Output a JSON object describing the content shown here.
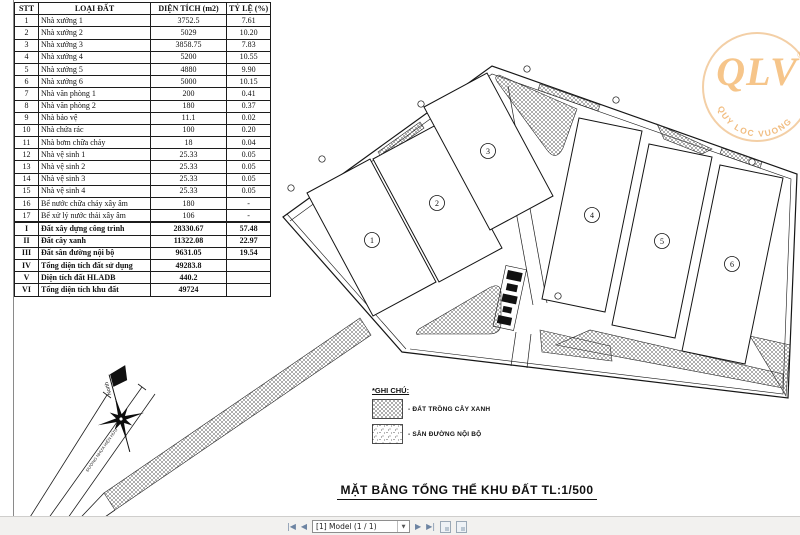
{
  "table": {
    "headers": [
      "STT",
      "LOẠI ĐẤT",
      "DIỆN TÍCH (m2)",
      "TỶ LỆ (%)"
    ],
    "rows": [
      {
        "no": "1",
        "name": "Nhà xưởng 1",
        "area": "3752.5",
        "ratio": "7.61"
      },
      {
        "no": "2",
        "name": "Nhà xưởng 2",
        "area": "5029",
        "ratio": "10.20"
      },
      {
        "no": "3",
        "name": "Nhà xưởng 3",
        "area": "3858.75",
        "ratio": "7.83"
      },
      {
        "no": "4",
        "name": "Nhà xưởng 4",
        "area": "5200",
        "ratio": "10.55"
      },
      {
        "no": "5",
        "name": "Nhà xưởng 5",
        "area": "4880",
        "ratio": "9.90"
      },
      {
        "no": "6",
        "name": "Nhà xưởng 6",
        "area": "5000",
        "ratio": "10.15"
      },
      {
        "no": "7",
        "name": "Nhà văn phòng 1",
        "area": "200",
        "ratio": "0.41"
      },
      {
        "no": "8",
        "name": "Nhà văn phòng 2",
        "area": "180",
        "ratio": "0.37"
      },
      {
        "no": "9",
        "name": "Nhà bảo vệ",
        "area": "11.1",
        "ratio": "0.02"
      },
      {
        "no": "10",
        "name": "Nhà chứa rác",
        "area": "100",
        "ratio": "0.20"
      },
      {
        "no": "11",
        "name": "Nhà bơm chữa cháy",
        "area": "18",
        "ratio": "0.04"
      },
      {
        "no": "12",
        "name": "Nhà vệ sinh 1",
        "area": "25.33",
        "ratio": "0.05"
      },
      {
        "no": "13",
        "name": "Nhà vệ sinh 2",
        "area": "25.33",
        "ratio": "0.05"
      },
      {
        "no": "14",
        "name": "Nhà vệ sinh 3",
        "area": "25.33",
        "ratio": "0.05"
      },
      {
        "no": "15",
        "name": "Nhà vệ sinh 4",
        "area": "25.33",
        "ratio": "0.05"
      },
      {
        "no": "16",
        "name": "Bể nước chữa cháy xây âm",
        "area": "180",
        "ratio": "-"
      },
      {
        "no": "17",
        "name": "Bể xử lý nước thải xây âm",
        "area": "106",
        "ratio": "-"
      },
      {
        "no": "I",
        "name": "Đất xây dựng công trình",
        "area": "28330.67",
        "ratio": "57.48"
      },
      {
        "no": "II",
        "name": "Đất cây xanh",
        "area": "11322.08",
        "ratio": "22.97"
      },
      {
        "no": "III",
        "name": "Đất sân đường nội bộ",
        "area": "9631.05",
        "ratio": "19.54"
      },
      {
        "no": "IV",
        "name": "Tổng diện tích đất sử dụng",
        "area": "49283.8",
        "ratio": ""
      },
      {
        "no": "V",
        "name": "Diện tích đất HLADB",
        "area": "440.2",
        "ratio": ""
      },
      {
        "no": "VI",
        "name": "Tổng diện tích khu đất",
        "area": "49724",
        "ratio": ""
      }
    ]
  },
  "plan": {
    "title": "MẶT BẰNG TỔNG THỂ KHU ĐẤT TL:1/500",
    "north_label": "North",
    "road_label": "ĐƯỜNG NHỰA HIỆN HỮU",
    "buildings": [
      "1",
      "2",
      "3",
      "4",
      "5",
      "6"
    ],
    "legend": {
      "heading": "*GHI CHÚ:",
      "items": [
        {
          "label": "- ĐẤT TRỒNG CÂY XANH"
        },
        {
          "label": "- SÂN ĐƯỜNG NỘI BỘ"
        }
      ]
    }
  },
  "watermark": {
    "text": "QLV",
    "reg": "®",
    "arc_text": "QUY LOC VUONG",
    "color": "#f0b877"
  },
  "toolbar": {
    "first_label": "|◀",
    "prev_label": "◀",
    "sheet_label": "[1] Model (1 / 1)",
    "caret": "▼",
    "next_label": "▶",
    "last_label": "▶|"
  }
}
